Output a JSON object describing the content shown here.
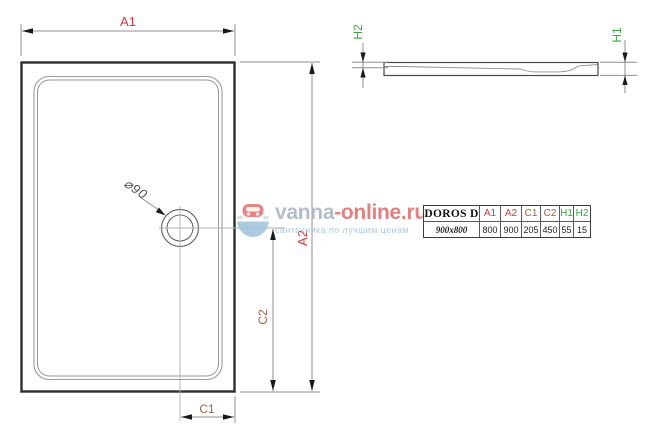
{
  "page": {
    "background": "#ffffff"
  },
  "dims": {
    "a1": "A1",
    "a2": "A2",
    "c1": "C1",
    "c2": "C2",
    "h1": "H1",
    "h2": "H2",
    "drain": "⌀90"
  },
  "dim_colors": {
    "a": "#d4383d",
    "c": "#a05f3a",
    "h": "#3da73e",
    "line": "#8f8f8f",
    "outline": "#2e2e2e"
  },
  "watermark": {
    "brand_primary": "vanna",
    "brand_secondary": "-online.ru",
    "tagline": "сантехника по лучшим ценам",
    "brand_primary_color": "#a6b2c2",
    "brand_secondary_color": "#de6a6a",
    "tagline_color": "#a3c0d6"
  },
  "table": {
    "model_label": "DOROS D",
    "size_label": "900x800",
    "columns": [
      {
        "label": "A1",
        "value": "800",
        "color": "#d4383d"
      },
      {
        "label": "A2",
        "value": "900",
        "color": "#d4383d"
      },
      {
        "label": "C1",
        "value": "205",
        "color": "#a05f3a"
      },
      {
        "label": "C2",
        "value": "450",
        "color": "#a05f3a"
      },
      {
        "label": "H1",
        "value": "55",
        "color": "#3da73e"
      },
      {
        "label": "H2",
        "value": "15",
        "color": "#3da73e"
      }
    ]
  }
}
